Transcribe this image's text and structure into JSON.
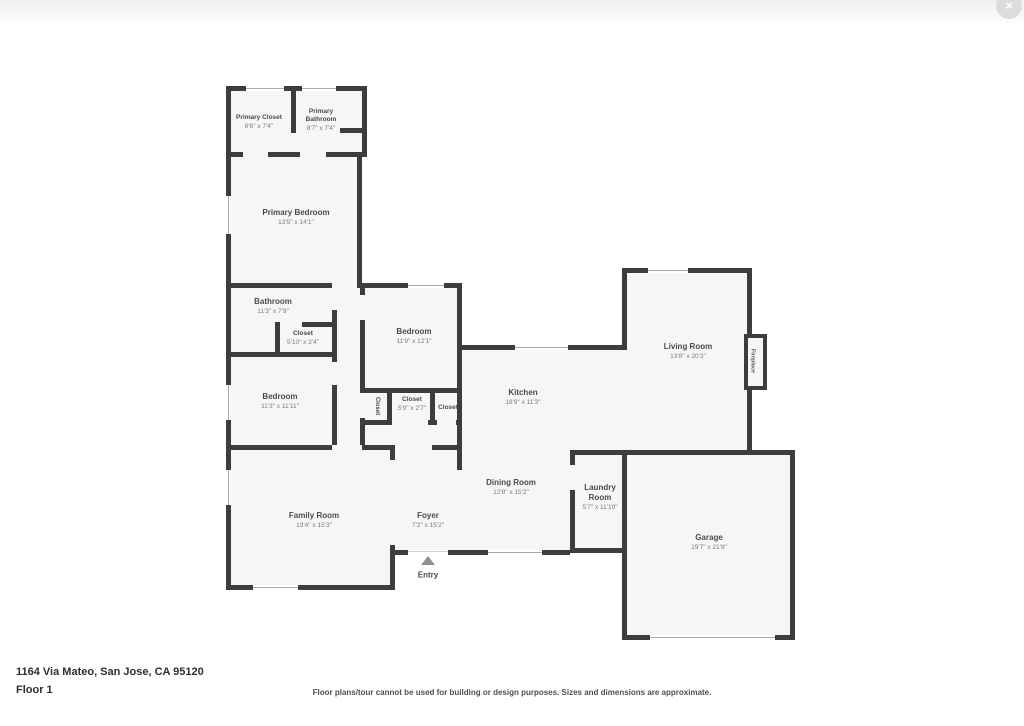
{
  "page": {
    "address": "1164 Via Mateo, San Jose, CA 95120",
    "floor_label": "Floor 1",
    "disclaimer": "Floor plans/tour cannot be used for building or design purposes. Sizes and dimensions are approximate."
  },
  "close_button": {
    "symbol": "×"
  },
  "entry": {
    "label": "Entry"
  },
  "colors": {
    "wall": "#3d3d3d",
    "room_fill": "#f6f6f6",
    "window_line": "#a9a9a9",
    "label_text": "#4a4a4a",
    "dims_text": "#7a7a7a"
  },
  "rooms": [
    {
      "name": "Primary Closet",
      "dims": "6'6\" x 7'4\""
    },
    {
      "name": "Primary Bathroom",
      "dims": "8'7\" x 7'4\""
    },
    {
      "name": "Primary Bedroom",
      "dims": "13'5\" x 14'1\""
    },
    {
      "name": "Bathroom",
      "dims": "11'3\" x 7'9\""
    },
    {
      "name": "Closet",
      "dims": "5'10\" x 2'4\""
    },
    {
      "name": "Bedroom",
      "dims": "11'9\" x 12'1\""
    },
    {
      "name": "Closet",
      "dims": ""
    },
    {
      "name": "Closet",
      "dims": "5'9\" x 2'7\""
    },
    {
      "name": "Closet",
      "dims": ""
    },
    {
      "name": "Bedroom",
      "dims": "11'3\" x 11'11\""
    },
    {
      "name": "Kitchen",
      "dims": "18'9\" x 11'3\""
    },
    {
      "name": "Living Room",
      "dims": "13'8\" x 20'3\""
    },
    {
      "name": "Fireplace",
      "dims": ""
    },
    {
      "name": "Dining Room",
      "dims": "12'8\" x 15'2\""
    },
    {
      "name": "Laundry Room",
      "dims": "5'7\" x 11'10\""
    },
    {
      "name": "Family Room",
      "dims": "19'4\" x 15'3\""
    },
    {
      "name": "Foyer",
      "dims": "7'2\" x 15'2\""
    },
    {
      "name": "Garage",
      "dims": "19'7\" x 21'9\""
    }
  ]
}
